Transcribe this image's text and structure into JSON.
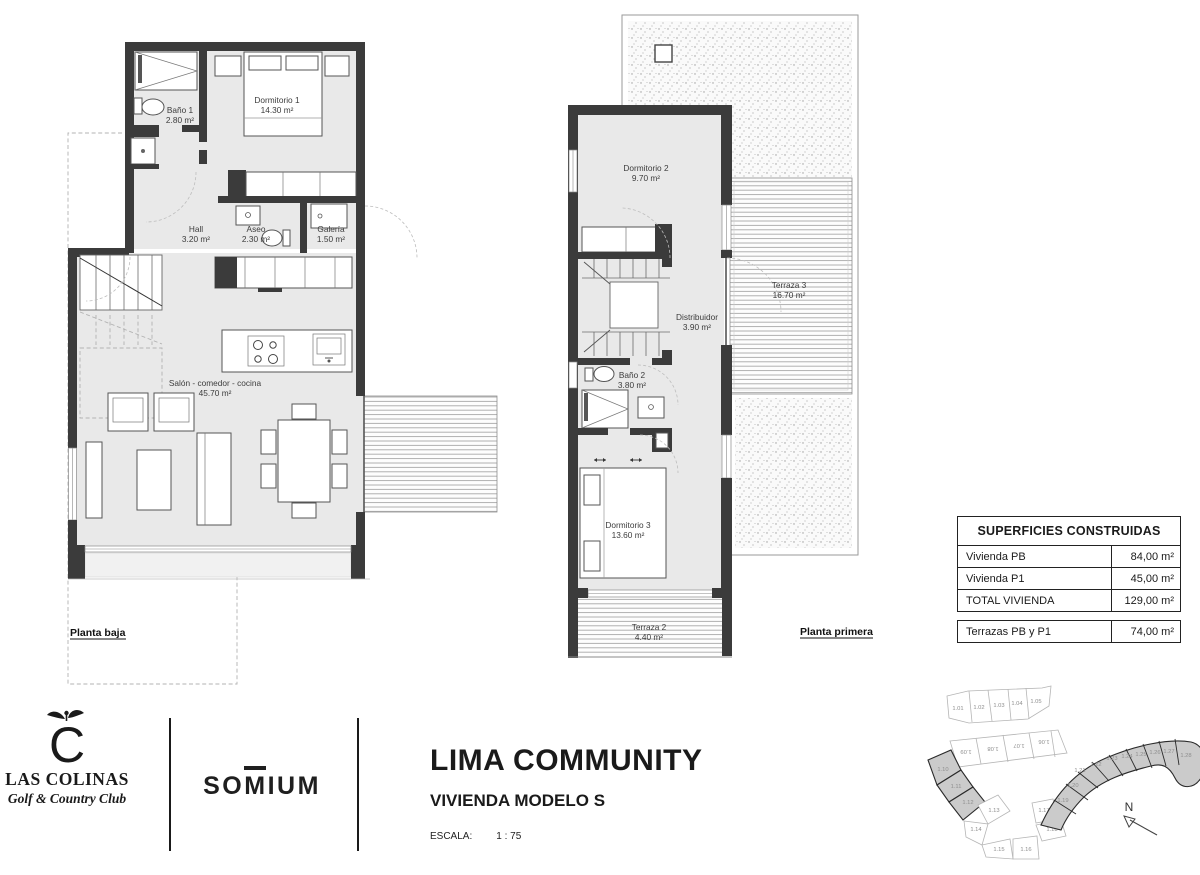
{
  "plans": {
    "baja": {
      "label": "Planta baja",
      "rooms": {
        "bano1": {
          "name": "Baño 1",
          "area": "2.80 m²"
        },
        "dorm1": {
          "name": "Dormitorio 1",
          "area": "14.30 m²"
        },
        "hall": {
          "name": "Hall",
          "area": "3.20 m²"
        },
        "aseo": {
          "name": "Aseo",
          "area": "2.30 m²"
        },
        "galeria": {
          "name": "Galería",
          "area": "1.50 m²"
        },
        "salon": {
          "name": "Salón - comedor - cocina",
          "area": "45.70 m²"
        }
      }
    },
    "primera": {
      "label": "Planta primera",
      "rooms": {
        "dorm2": {
          "name": "Dormitorio 2",
          "area": "9.70 m²"
        },
        "terraza3": {
          "name": "Terraza 3",
          "area": "16.70 m²"
        },
        "distribuidor": {
          "name": "Distribuidor",
          "area": "3.90 m²"
        },
        "bano2": {
          "name": "Baño 2",
          "area": "3.80 m²"
        },
        "dorm3": {
          "name": "Dormitorio 3",
          "area": "13.60 m²"
        },
        "terraza2": {
          "name": "Terraza 2",
          "area": "4.40 m²"
        }
      }
    }
  },
  "surfaces": {
    "title": "SUPERFICIES CONSTRUIDAS",
    "rows": [
      {
        "label": "Vivienda PB",
        "value": "84,00 m²"
      },
      {
        "label": "Vivienda P1",
        "value": "45,00 m²"
      },
      {
        "label": "TOTAL VIVIENDA",
        "value": "129,00 m²"
      }
    ],
    "terrace_row": {
      "label": "Terrazas PB y P1",
      "value": "74,00 m²"
    }
  },
  "footer": {
    "las_colinas": {
      "monogram": "C",
      "name": "LAS COLINAS",
      "tagline": "Golf & Country Club"
    },
    "somium": {
      "pre": "SO",
      "m": "M",
      "post": "IUM"
    },
    "project_title": "LIMA COMMUNITY",
    "project_subtitle": "VIVIENDA MODELO S",
    "scale_label": "ESCALA:",
    "scale_value": "1 : 75"
  },
  "site_plan": {
    "north_label": "N",
    "plots_top": [
      "1.01",
      "1.02",
      "1.03",
      "1.04",
      "1.05"
    ],
    "plots_mid": [
      "1.09",
      "1.08",
      "1.07",
      "1.06"
    ],
    "plots_left": [
      "1.10",
      "1.11",
      "1.12"
    ],
    "plots_bottom": [
      "1.13",
      "1.14",
      "1.15",
      "1.16",
      "1.17",
      "1.18"
    ],
    "plots_right": [
      "1.19",
      "1.20",
      "1.21",
      "1.22",
      "1.23",
      "1.24",
      "1.25",
      "1.26",
      "1.27",
      "1.28"
    ]
  },
  "colors": {
    "wall": "#3b3b3b",
    "floor": "#e9e9e9",
    "plot_highlight": "#cbcbcb",
    "ink": "#1a1a1a"
  }
}
